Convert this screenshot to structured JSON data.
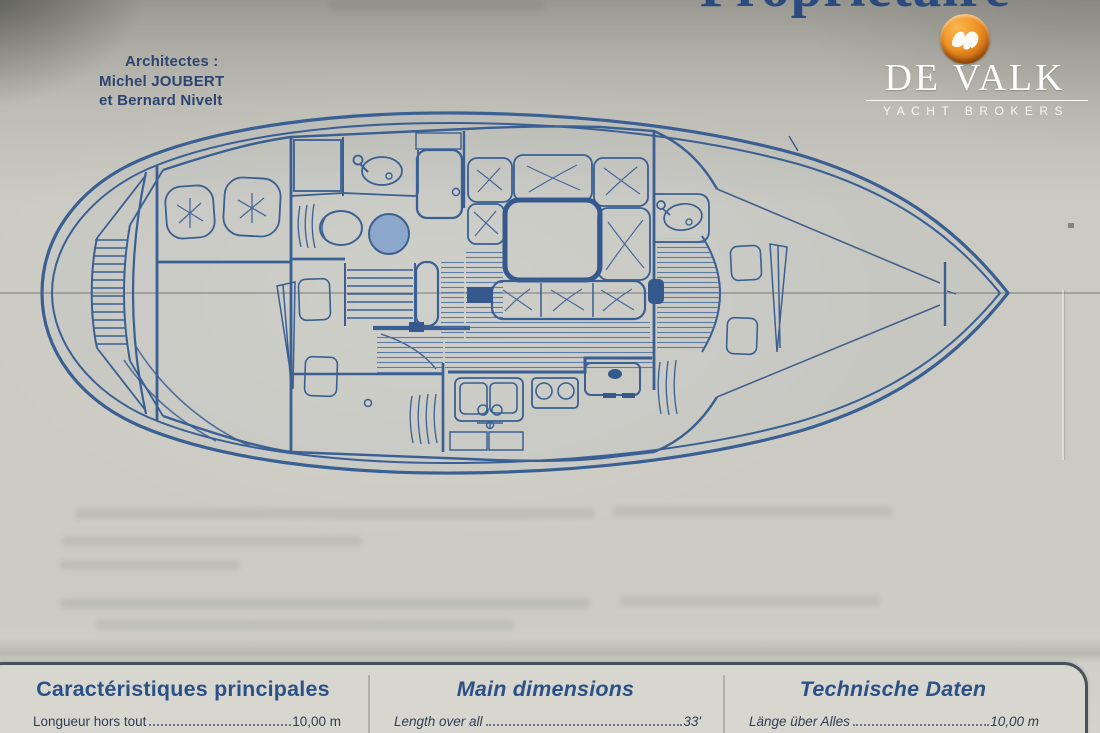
{
  "document": {
    "title_partial": "Propriétaire",
    "architects": {
      "line1": "Architectes :",
      "line2": "Michel JOUBERT",
      "line3": "et Bernard Nivelt"
    }
  },
  "logo": {
    "brand": "DE VALK",
    "tagline": "YACHT BROKERS",
    "icon": "falcon-icon",
    "circle_color": "#ef9022"
  },
  "plan": {
    "type": "sailboat-interior-floorplan",
    "ink_color": "#3a5f92",
    "centerline_color": "#5a5a55",
    "shower_basin_fill": "#8ba7ca"
  },
  "specs": {
    "columns": [
      {
        "header": "Caractéristiques principales",
        "rows": [
          {
            "label": "Longueur hors tout",
            "value": "10,00 m"
          }
        ]
      },
      {
        "header": "Main dimensions",
        "rows": [
          {
            "label": "Length over all",
            "value": "33'"
          }
        ]
      },
      {
        "header": "Technische Daten",
        "rows": [
          {
            "label": "Länge über Alles",
            "value": "10,00 m"
          }
        ]
      }
    ]
  }
}
